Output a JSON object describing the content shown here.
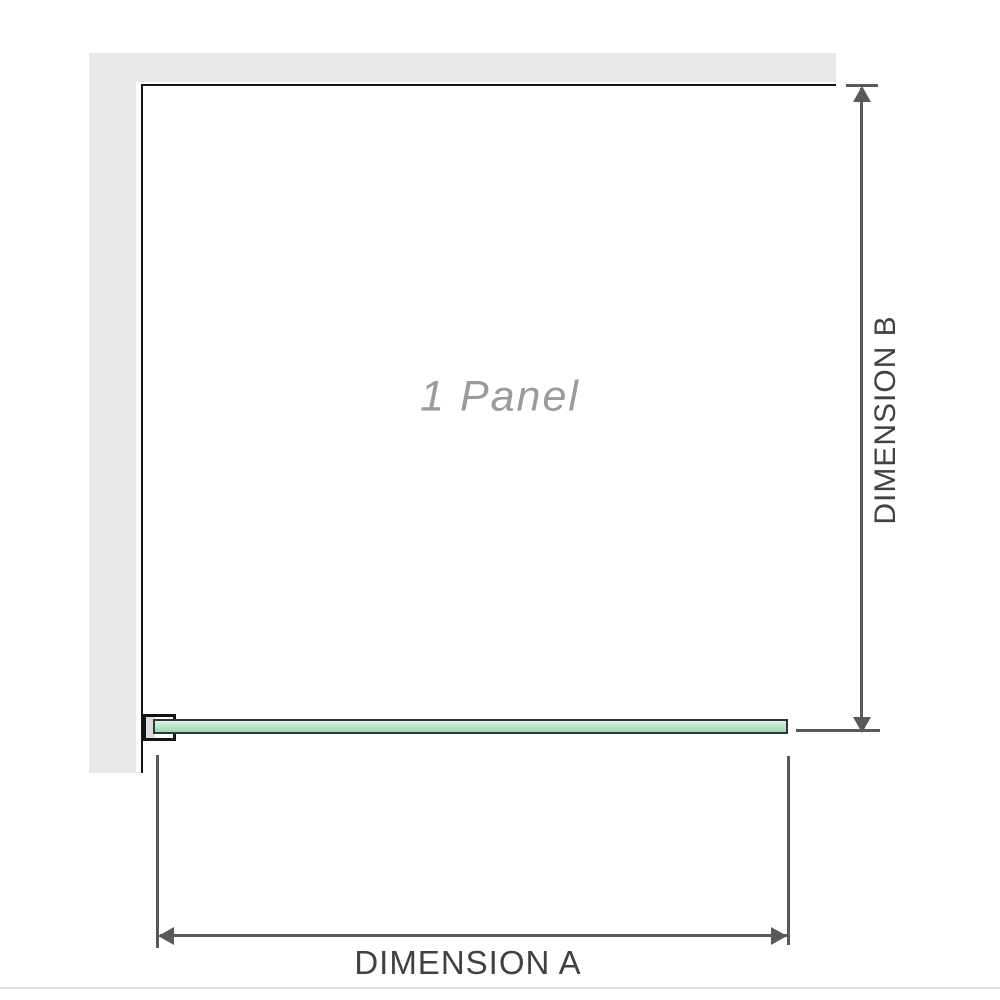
{
  "diagram": {
    "panel_label": "1 Panel",
    "dimension_a_label": "DIMENSION A",
    "dimension_b_label": "DIMENSION B"
  },
  "colors": {
    "wall": "#e9e9e9",
    "outline": "#141414",
    "dimension": "#58595b",
    "label_text": "#3f4143",
    "panel_text": "#9b9b9b",
    "glass_border": "#2b3a31",
    "clamp_fill": "#dcdcdc",
    "baseline": "#dfdfdf"
  }
}
